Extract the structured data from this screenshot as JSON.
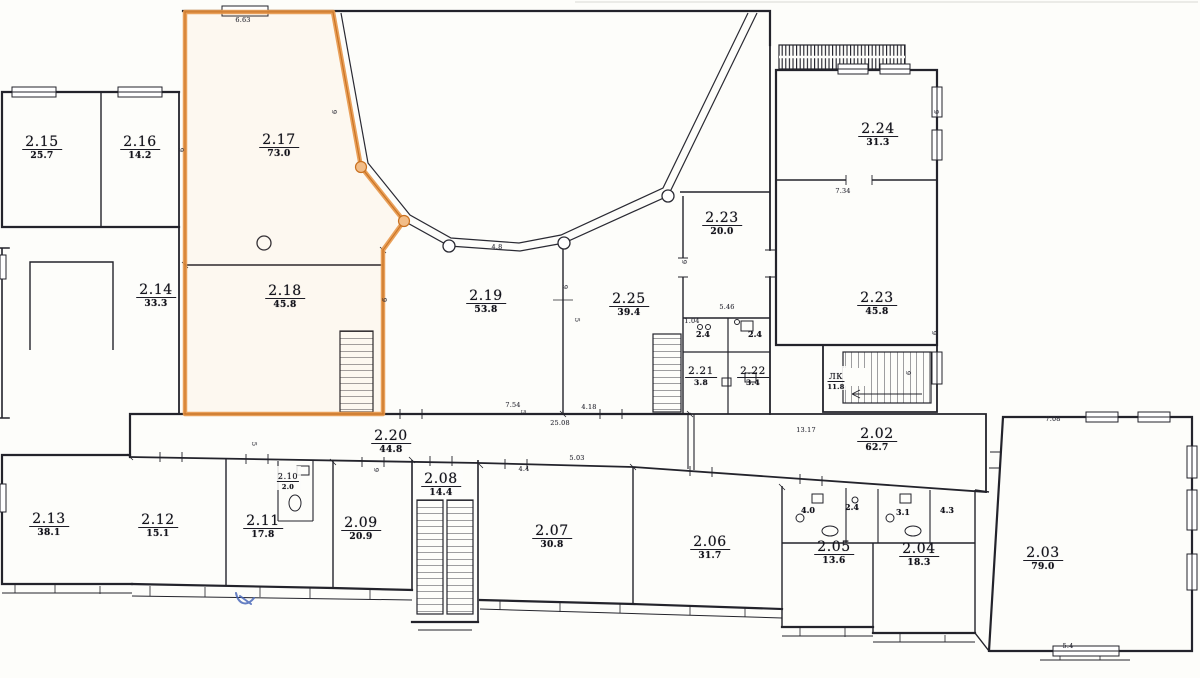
{
  "document": {
    "type": "scanned floor plan, level 2"
  },
  "colors": {
    "highlight_stroke": "#e8994d",
    "highlight_core": "#c9701f",
    "highlight_node_fill": "#f2bd88",
    "ink": "#23232b",
    "pen_annotation": "#4a68b8"
  },
  "rooms": [
    {
      "num": "2.15",
      "area": "25.7"
    },
    {
      "num": "2.16",
      "area": "14.2"
    },
    {
      "num": "2.17",
      "area": "73.0"
    },
    {
      "num": "2.14",
      "area": "33.3"
    },
    {
      "num": "2.18",
      "area": "45.8"
    },
    {
      "num": "2.19",
      "area": "53.8"
    },
    {
      "num": "2.25",
      "area": "39.4"
    },
    {
      "num": "2.23",
      "area": "20.0"
    },
    {
      "num": "2.24",
      "area": "31.3"
    },
    {
      "num": "2.23",
      "area": "45.8"
    },
    {
      "num": "2.21",
      "area": "3.8"
    },
    {
      "num": "2.22",
      "area": "3.4"
    },
    {
      "num": "ЛК",
      "area": "11.8"
    },
    {
      "num": "2.20",
      "area": "44.8"
    },
    {
      "num": "2.02",
      "area": "62.7"
    },
    {
      "num": "2.13",
      "area": "38.1"
    },
    {
      "num": "2.12",
      "area": "15.1"
    },
    {
      "num": "2.11",
      "area": "17.8"
    },
    {
      "num": "2.10",
      "area": "2.0"
    },
    {
      "num": "2.09",
      "area": "20.9"
    },
    {
      "num": "2.08",
      "area": "14.4"
    },
    {
      "num": "2.07",
      "area": "30.8"
    },
    {
      "num": "2.06",
      "area": "31.7"
    },
    {
      "num": "2.05",
      "area": "13.6"
    },
    {
      "num": "2.04",
      "area": "18.3"
    },
    {
      "num": "2.03",
      "area": "79.0"
    }
  ],
  "small_labels": [
    "2.4",
    "2.4",
    "4.0",
    "2.4",
    "3.1",
    "4.3"
  ],
  "dims": [
    "6.63",
    "4.8",
    "7.54",
    "4.18",
    "25.08",
    "13.17",
    "7.34",
    "5.46",
    "7.08",
    "5.4",
    "4.4",
    "5.03",
    "1.04",
    "9",
    "9",
    "9",
    "9",
    "9",
    "9",
    "9",
    "9",
    "9",
    "5",
    "5",
    "5"
  ]
}
